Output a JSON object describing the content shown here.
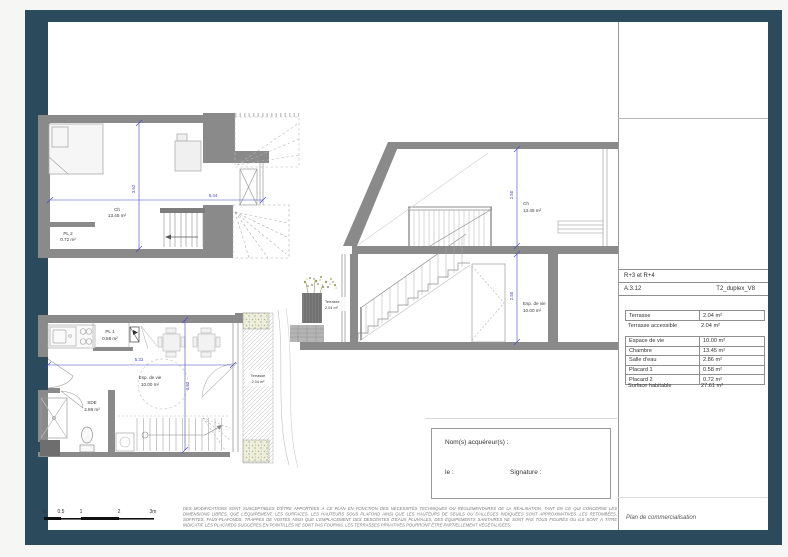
{
  "colors": {
    "frame": "#2b4a5c",
    "wall": "#8a8a8a",
    "dimension": "#4444c8"
  },
  "title_block": {
    "levels": "R+3 et R+4",
    "ref": "A.3.12",
    "plan_name": "T2_duplex_V8",
    "outdoor_areas": [
      {
        "label": "Terrasse",
        "value": "2.04 m²"
      },
      {
        "label": "Terrasse accessible",
        "value": "2.04 m²"
      }
    ],
    "indoor_areas": [
      {
        "label": "Espace de vie",
        "value": "10.00 m²"
      },
      {
        "label": "Chambre",
        "value": "13.45 m²"
      },
      {
        "label": "Salle d'eau",
        "value": "2.86 m²"
      },
      {
        "label": "Placard 1",
        "value": "0.58 m²"
      },
      {
        "label": "Placard 2",
        "value": "0.72 m²"
      }
    ],
    "total": {
      "label": "Surface habitable",
      "value": "27.61 m²"
    },
    "doc_type": "Plan de commercialisation"
  },
  "buyer_box": {
    "title": "Nom(s) acquéreur(s) :",
    "date_label": "le :",
    "signature_label": "Signature :"
  },
  "scale_bar": {
    "labels": [
      "0",
      "0.5",
      "1",
      "2",
      "3m"
    ]
  },
  "disclaimer": "DES MODIFICATIONS SONT SUSCEPTIBLES D'ÊTRE APPORTÉES À CE PLAN EN FONCTION DES NÉCESSITÉS TECHNIQUES OU RÉGLEMENTAIRES DE LA RÉALISATION, TANT EN CE QUI CONCERNE LES DIMENSIONS LIBRES, QUE L'ÉQUIPEMENT, LES SURFACES. LES HAUTEURS SOUS PLAFOND AINSI QUE LES HAUTEURS DE SEUILS OU D'ALLÈGES INDIQUÉES SONT APPROXIMATIVES. LES RETOMBÉES, SOFFITES, FAUX-PLAFONDS, TRAPPES DE VISITES AINSI QUE L'EMPLACEMENT DES DESCENTES D'EAUX PLUVIALES, DES ÉQUIPEMENTS SANITAIRES NE SONT PAS TOUS FIGURÉS OU ILS SONT À TITRE INDICATIF. LES PLACARDS SUGGÉRÉS EN POINTILLÉS NE SONT PAS FOURNIS. LES TERRASSES PRIVATIVES POURRONT ÊTRE PARTIELLEMENT VÉGÉTALISÉES.",
  "plans": {
    "upper_floor": {
      "bedroom_label": "Ch",
      "bedroom_area": "13.45 m²",
      "closet_label": "PL 2",
      "closet_area": "0.72 m²",
      "width_dim": "5.44",
      "height_dim": "3.52"
    },
    "section": {
      "bedroom_label": "Ch",
      "bedroom_area": "13.45 m²",
      "living_label": "Esp. de vie",
      "living_area": "10.00 m²",
      "terrace_label": "Terrasse",
      "terrace_area": "2.04 m²",
      "upper_height": "2.50",
      "lower_height": "2.50"
    },
    "lower_floor": {
      "living_label": "Esp. de vie",
      "living_area": "10.00 m²",
      "closet_label": "PL 1",
      "closet_area": "0.58 m²",
      "bathroom_label": "SDE",
      "bathroom_area": "2.86 m²",
      "terrace_label": "Terrasse",
      "terrace_area": "2.04 m²",
      "width_dim": "5.32",
      "height_dim": "3.52"
    }
  }
}
